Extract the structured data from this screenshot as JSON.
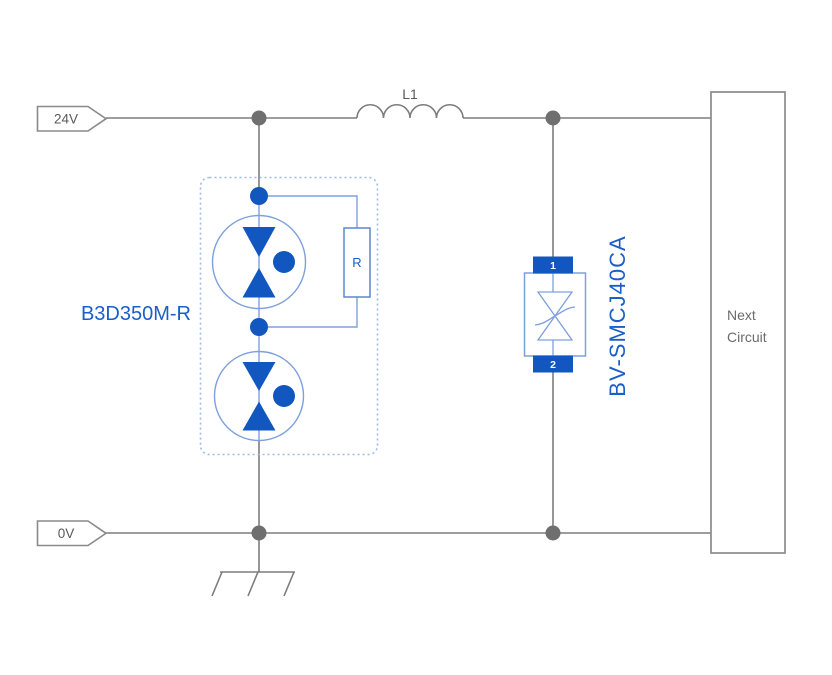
{
  "schematic": {
    "nets": {
      "vin_label": "24V",
      "gnd_label": "0V"
    },
    "inductor": {
      "ref": "L1"
    },
    "surge_module": {
      "part_number": "B3D350M-R",
      "resistor_label": "R"
    },
    "tvs": {
      "part_number": "BV-SMCJ40CA",
      "pin_top": "1",
      "pin_bottom": "2"
    },
    "next_circuit": {
      "line1": "Next",
      "line2": "Circuit"
    }
  },
  "colors": {
    "wire_gray": "#7d7d7d",
    "junction_gray": "#6f6f6f",
    "box_gray": "#8a8a8a",
    "text_gray": "#595959",
    "blue_solid": "#1256c0",
    "blue_text": "#1a5fc9",
    "blue_light": "#7da0dc",
    "blue_border": "#5b86d2",
    "dashed_border": "#9fbae6"
  }
}
